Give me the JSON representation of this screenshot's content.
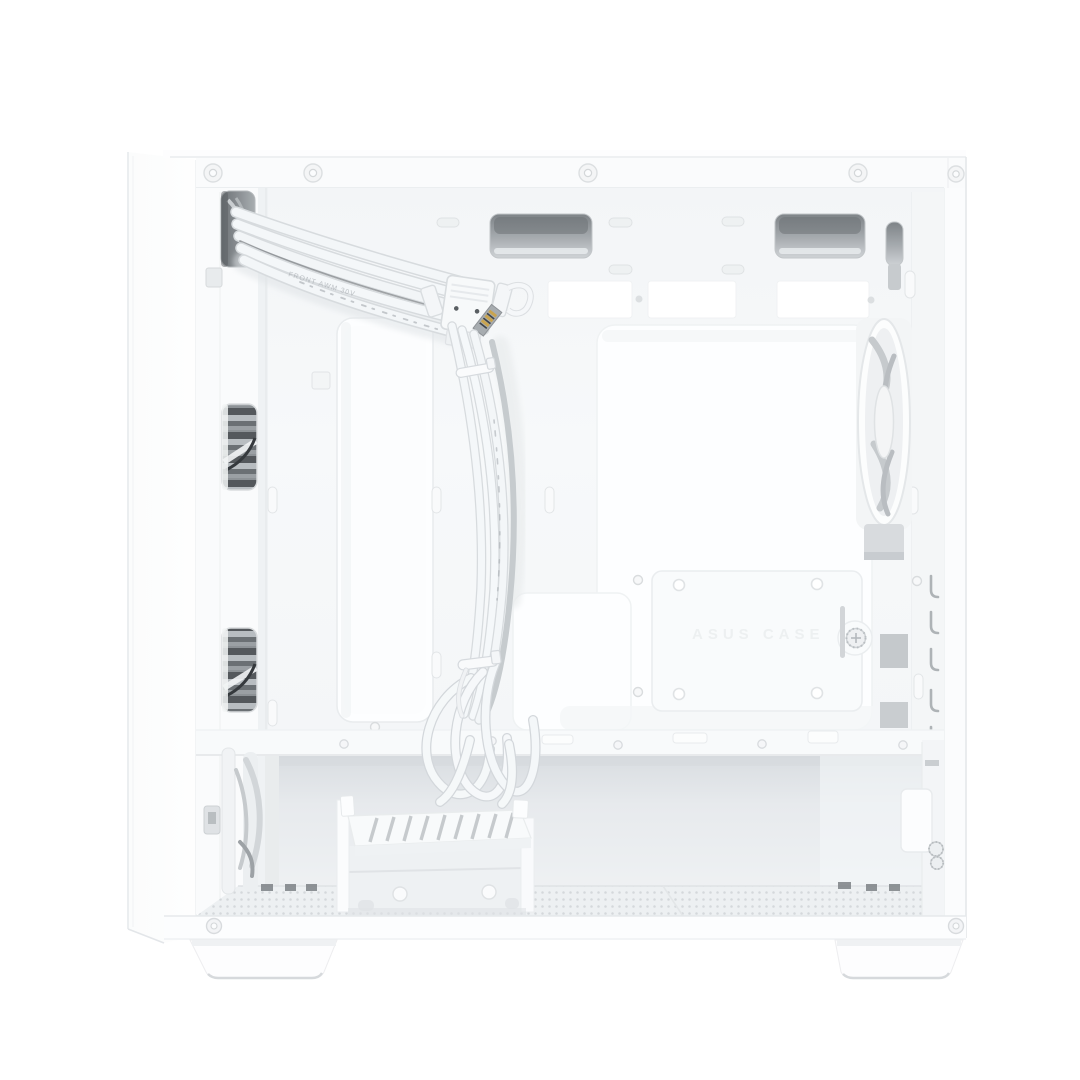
{
  "image": {
    "type": "product-photo",
    "subject": "White micro-ATX PC tower case, interior side view with side panel removed, white front-panel cables routed behind motherboard tray",
    "background_color": "#ffffff"
  },
  "case": {
    "embossed_text": "ASUS CASE",
    "cable_print": "FRONT AWM 30V",
    "body_color": "#f7f9fa",
    "panel_edge_color": "#e6e9eb",
    "slot_color": "#8b9094",
    "chamber_shadow_color": "#dce0e3",
    "mesh_dot_color": "#d4d8db",
    "cable_color": "#f3f6f8",
    "cable_edge_color": "#d7dbde",
    "gold_pin_color": "#c9a44f",
    "fan_blade_color": "#c6cacd",
    "dark_vent_color": "#54585c"
  },
  "parts": [
    "front bezel",
    "top rail with rivets",
    "front-panel cable pass-through",
    "cable grommet slots",
    "motherboard tray",
    "vertical cable routing channel",
    "front fan openings",
    "rear exhaust fan",
    "ssd mount plate with thumbscrew",
    "cable bundle with zip ties",
    "coiled front-panel cables",
    "hdd drive cage",
    "psu bay mesh floor",
    "psu mounting bracket",
    "cable tie hooks",
    "case feet"
  ]
}
